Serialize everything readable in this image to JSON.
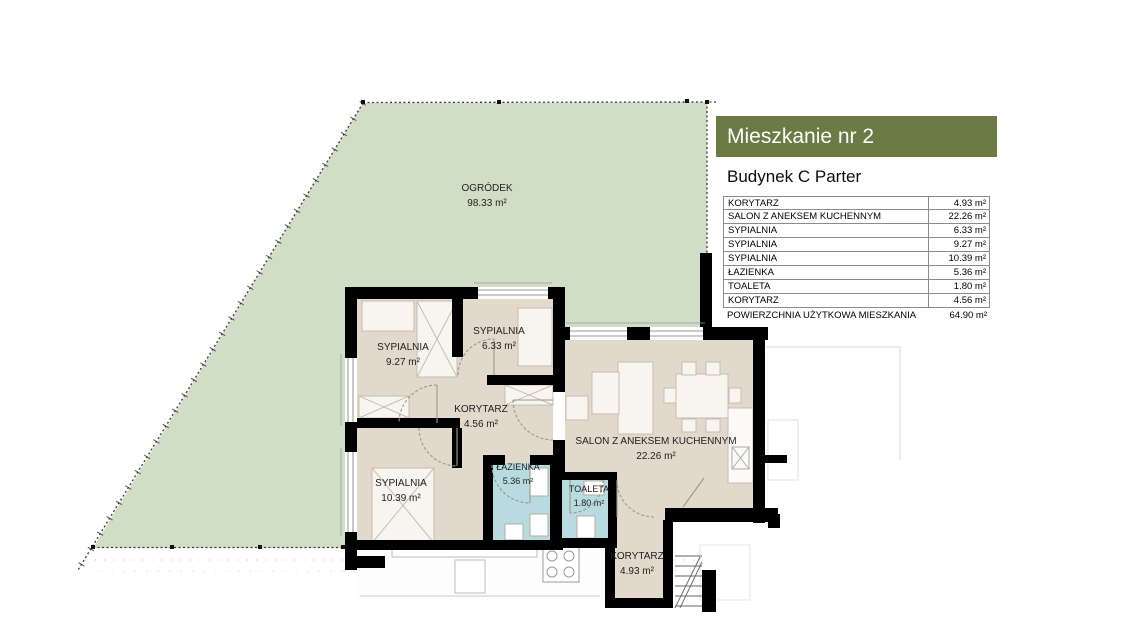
{
  "panel": {
    "title": "Mieszkanie nr 2",
    "subtitle": "Budynek C Parter",
    "rows": [
      {
        "label": "KORYTARZ",
        "value": "4.93 m²"
      },
      {
        "label": "SALON Z ANEKSEM KUCHENNYM",
        "value": "22.26 m²"
      },
      {
        "label": "SYPIALNIA",
        "value": "6.33 m²"
      },
      {
        "label": "SYPIALNIA",
        "value": "9.27 m²"
      },
      {
        "label": "SYPIALNIA",
        "value": "10.39 m²"
      },
      {
        "label": "ŁAZIENKA",
        "value": "5.36 m²"
      },
      {
        "label": "TOALETA",
        "value": "1.80 m²"
      },
      {
        "label": "KORYTARZ",
        "value": "4.56 m²"
      }
    ],
    "summary": {
      "label": "POWIERZCHNIA UŻYTKOWA MIESZKANIA",
      "value": "64.90 m²"
    }
  },
  "plan": {
    "garden": {
      "name": "OGRÓDEK",
      "area": "98.33 m²"
    },
    "rooms": [
      {
        "name": "SYPIALNIA",
        "area": "9.27 m²"
      },
      {
        "name": "SYPIALNIA",
        "area": "6.33 m²"
      },
      {
        "name": "KORYTARZ",
        "area": "4.56 m²"
      },
      {
        "name": "SYPIALNIA",
        "area": "10.39 m²"
      },
      {
        "name": "ŁAZIENKA",
        "area": "5.36 m²"
      },
      {
        "name": "TOALETA",
        "area": "1.80 m²"
      },
      {
        "name": "SALON Z ANEKSEM KUCHENNYM",
        "area": "22.26 m²"
      },
      {
        "name": "KORYTARZ",
        "area": "4.93 m²"
      }
    ]
  },
  "colors": {
    "accent": "#6b7b44",
    "garden": "#d0dec5",
    "floor": "#e2d8cb",
    "wet_room": "#b7dbdf",
    "wall": "#000000"
  }
}
